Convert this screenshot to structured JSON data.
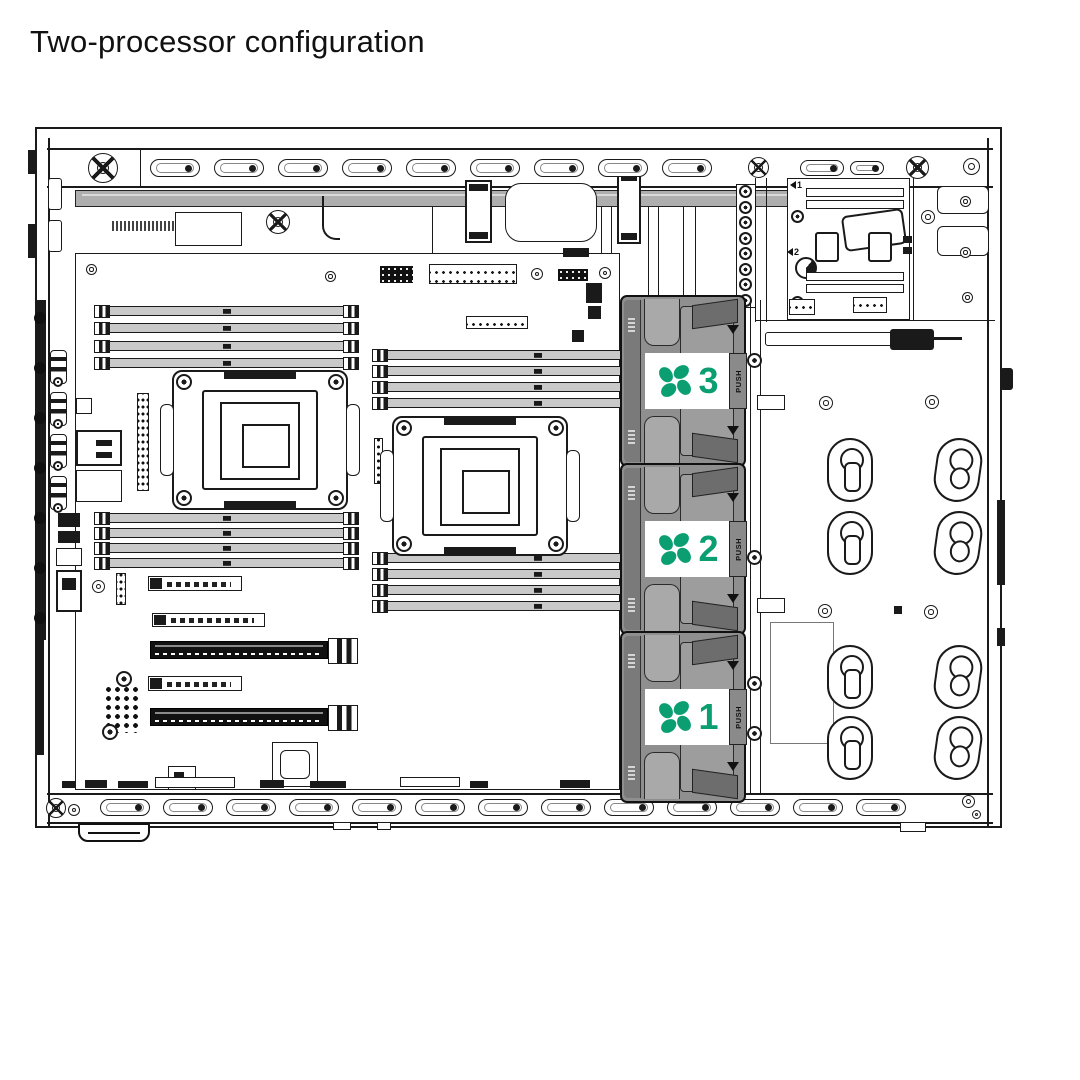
{
  "page": {
    "title": "Two-processor configuration"
  },
  "diagram": {
    "description": "Interior view of a tower server chassis showing the system board with two processor sockets, DIMM slots, expansion slots and three hot-plug fan modules",
    "fan_count": 3
  },
  "fans": [
    {
      "id": "fan-3",
      "number": "3",
      "push_label": "PUSH"
    },
    {
      "id": "fan-2",
      "number": "2",
      "push_label": "PUSH"
    },
    {
      "id": "fan-1",
      "number": "1",
      "push_label": "PUSH"
    }
  ],
  "psu_area": {
    "connector1_label": "1",
    "connector2_label": "2"
  },
  "colors": {
    "accent_green": "#0a9e70",
    "line": "#1a1a1a",
    "fan_body": "#8f8f8f",
    "rail_gray": "#aeaeae"
  }
}
